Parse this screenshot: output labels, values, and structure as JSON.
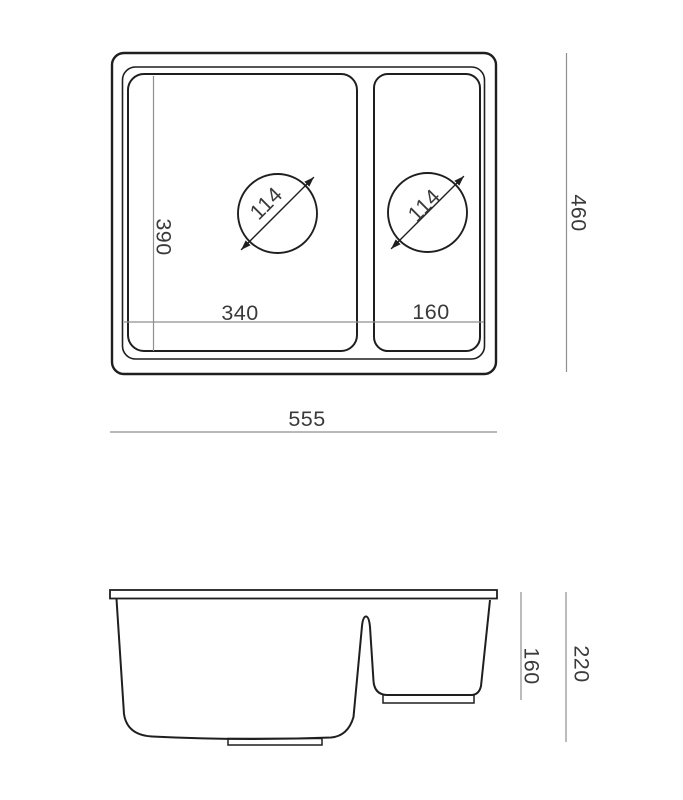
{
  "colors": {
    "line-color": "#1f1f1f",
    "dim-line-color": "#8f8f8f",
    "text-color": "#3a3a3a",
    "background-color": "#ffffff"
  },
  "top_view": {
    "dims": {
      "main_bowl_width": "340",
      "small_bowl_width": "160",
      "main_bowl_depth": "390",
      "overall_depth": "460",
      "overall_width": "555",
      "main_drain_diameter": "114",
      "small_drain_diameter": "114"
    }
  },
  "side_view": {
    "dims": {
      "small_bowl_height": "160",
      "overall_height": "220"
    }
  }
}
